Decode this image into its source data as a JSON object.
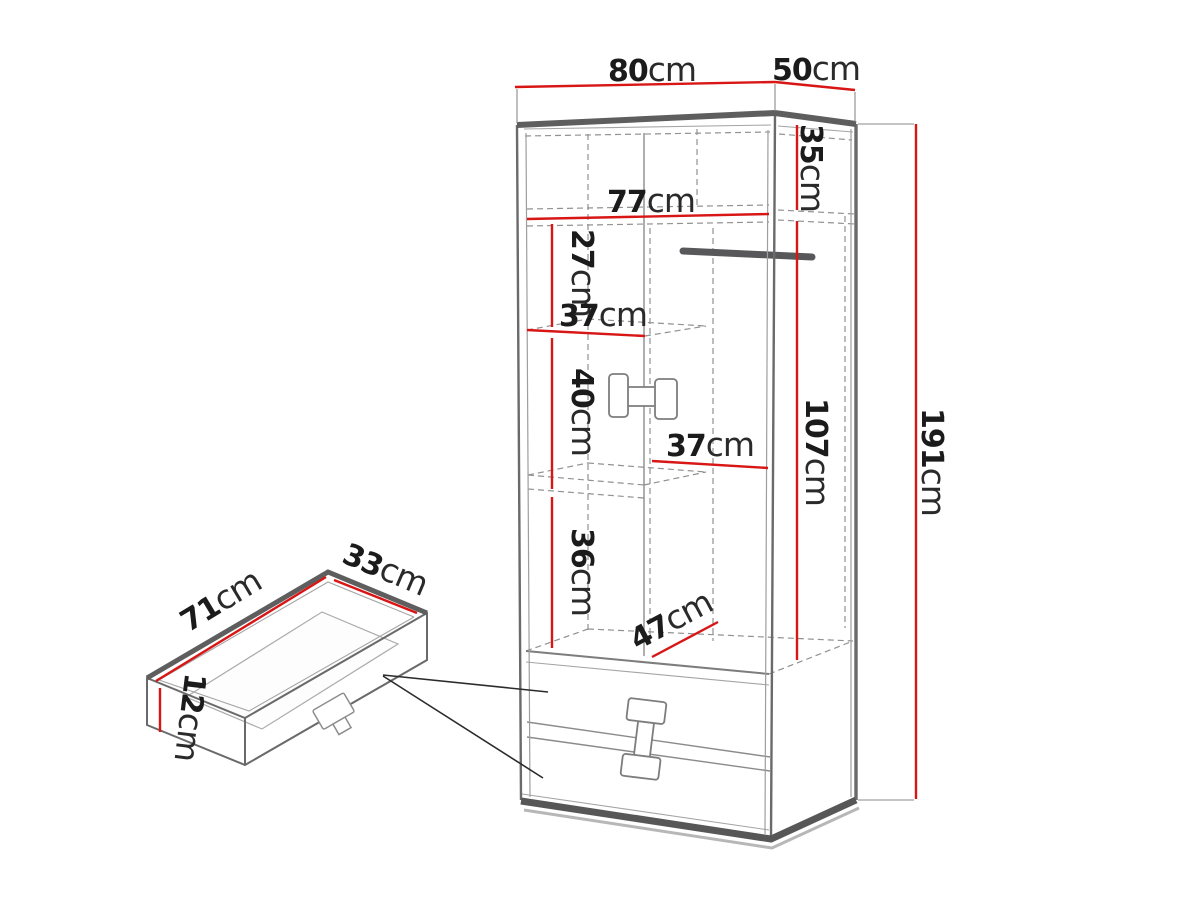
{
  "figure": {
    "kind": "furniture-dimension-diagram",
    "unit": "cm",
    "accent_color": "#d81616",
    "edge_color": "#6a6a6a",
    "background": "#ffffff"
  },
  "wardrobe": {
    "overall": {
      "width": {
        "value": "80",
        "unit": "cm"
      },
      "depth": {
        "value": "50",
        "unit": "cm"
      },
      "height": {
        "value": "191",
        "unit": "cm"
      }
    },
    "interior": {
      "top_section_height": {
        "value": "35",
        "unit": "cm"
      },
      "inner_width": {
        "value": "77",
        "unit": "cm"
      },
      "upper_gap": {
        "value": "27",
        "unit": "cm"
      },
      "shelf_width": {
        "value": "37",
        "unit": "cm"
      },
      "middle_gap": {
        "value": "40",
        "unit": "cm"
      },
      "lower_gap": {
        "value": "36",
        "unit": "cm"
      },
      "hanging_height": {
        "value": "107",
        "unit": "cm"
      },
      "hanging_width": {
        "value": "37",
        "unit": "cm"
      },
      "bottom_shelf_depth": {
        "value": "47",
        "unit": "cm"
      }
    }
  },
  "drawer_detail": {
    "width": {
      "value": "71",
      "unit": "cm"
    },
    "depth": {
      "value": "33",
      "unit": "cm"
    },
    "height": {
      "value": "12",
      "unit": "cm"
    }
  }
}
